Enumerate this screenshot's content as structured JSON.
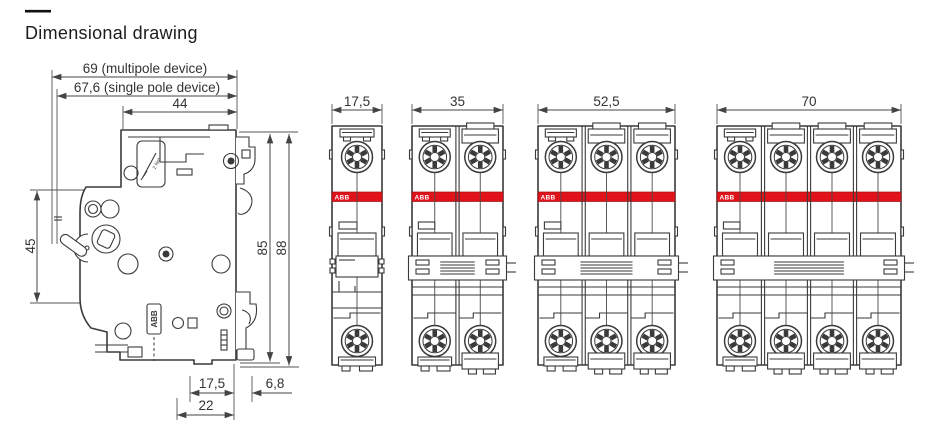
{
  "page": {
    "title_dash": "—",
    "title": "Dimensional drawing"
  },
  "colors": {
    "abb_red": "#e2121b",
    "line": "#3a3a3a",
    "text": "#333333",
    "background": "#ffffff"
  },
  "side_view": {
    "dims": {
      "depth_multipole": "69 (multipole device)",
      "depth_singlepole": "67,6 (single pole device)",
      "upper_depth": "44",
      "front_height": "45",
      "mounting_height": "85",
      "overall_height": "88",
      "din_notch_depth": "17,5",
      "rear_notch_depth": "6,8",
      "base_width": "22"
    },
    "labels": {
      "torque": "2 Nm",
      "brand": "ABB"
    }
  },
  "front_views": [
    {
      "poles": 1,
      "width_label": "17,5",
      "brand": "ABB"
    },
    {
      "poles": 2,
      "width_label": "35",
      "brand": "ABB"
    },
    {
      "poles": 3,
      "width_label": "52,5",
      "brand": "ABB"
    },
    {
      "poles": 4,
      "width_label": "70",
      "brand": "ABB"
    }
  ]
}
